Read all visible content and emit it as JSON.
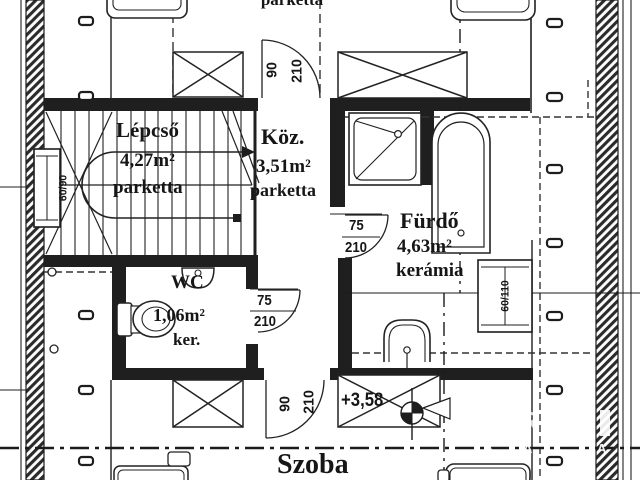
{
  "plan": {
    "top_room": {
      "floor": "parketta"
    },
    "stairs": {
      "name": "Lépcső",
      "area": "4,27m²",
      "floor": "parketta"
    },
    "hall": {
      "name": "Köz.",
      "area": "3,51m²",
      "floor": "parketta"
    },
    "bathroom": {
      "name": "Fürdő",
      "area": "4,63m²",
      "floor": "kerámia"
    },
    "wc": {
      "name": "WC",
      "area": "1,06m²",
      "floor": "ker."
    },
    "room": {
      "name": "Szoba"
    },
    "level_marker": "+3,58",
    "doors": {
      "hall_top": {
        "w": "90",
        "h": "210"
      },
      "bathroom": {
        "w": "75",
        "h": "210"
      },
      "wc": {
        "w": "75",
        "h": "210"
      },
      "room_bottom": {
        "w": "90",
        "h": "210"
      }
    },
    "windows": {
      "left": "60/90",
      "right": "60/110"
    },
    "watermark": {
      "a1": "A",
      "a2": "A",
      "a3": "K",
      "a4": "A",
      "big": "R"
    }
  }
}
